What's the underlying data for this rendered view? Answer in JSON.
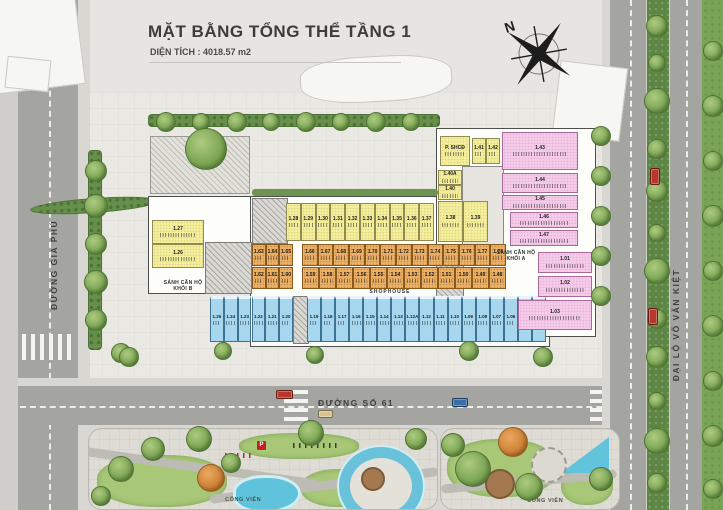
{
  "header": {
    "title": "MẶT BẰNG TỔNG THỂ TẦNG 1",
    "subtitle": "DIỆN TÍCH : 4018.57 m2"
  },
  "compass": {
    "label": "N"
  },
  "streets": {
    "left": "ĐƯỜNG GIA PHÚ",
    "bottom": "ĐƯỜNG SỐ 61",
    "right": "ĐẠI LỘ VÕ VĂN KIỆT"
  },
  "building": {
    "labels": {
      "lobby_a": "SẢNH CĂN HỘ\nKHỐI A",
      "lobby_b": "SẢNH CĂN HỘ\nKHỐI B",
      "shophouse": "SHOPHOUSE"
    },
    "blocks": [
      {
        "name": "yellow-top-row",
        "color": "yellow",
        "x": 286,
        "y": 203,
        "w": 148,
        "h": 38,
        "labels": [
          "1.28",
          "1.29",
          "1.30",
          "1.31",
          "1.32",
          "1.33",
          "1.34",
          "1.35",
          "1.36",
          "1.37"
        ]
      },
      {
        "name": "yellow-pair",
        "color": "yellow",
        "x": 438,
        "y": 201,
        "w": 50,
        "h": 41,
        "labels": [
          "1.38",
          "1.39"
        ]
      },
      {
        "name": "orange-top-left",
        "color": "orange",
        "x": 252,
        "y": 244,
        "w": 41,
        "h": 22,
        "labels": [
          "1.63",
          "1.64",
          "1.65"
        ]
      },
      {
        "name": "orange-top-right",
        "color": "orange",
        "x": 302,
        "y": 244,
        "w": 204,
        "h": 22,
        "labels": [
          "1.66",
          "1.67",
          "1.68",
          "1.69",
          "1.70",
          "1.71",
          "1.72",
          "1.73",
          "1.74",
          "1.75",
          "1.76",
          "1.77",
          "1.78"
        ]
      },
      {
        "name": "orange-bottom-left",
        "color": "orange",
        "x": 252,
        "y": 267,
        "w": 41,
        "h": 22,
        "labels": [
          "1.62",
          "1.61",
          "1.60"
        ]
      },
      {
        "name": "orange-bottom-right",
        "color": "orange",
        "x": 302,
        "y": 267,
        "w": 204,
        "h": 22,
        "labels": [
          "1.59",
          "1.58",
          "1.57",
          "1.56",
          "1.55",
          "1.54",
          "1.53",
          "1.52",
          "1.51",
          "1.50",
          "1.49",
          "1.48"
        ]
      },
      {
        "name": "blue-row-left",
        "color": "blue",
        "x": 210,
        "y": 296,
        "w": 83,
        "h": 46,
        "labels": [
          "1.25",
          "1.24",
          "1.23",
          "1.22",
          "1.21",
          "1.20"
        ]
      },
      {
        "name": "blue-row-right",
        "color": "blue",
        "x": 307,
        "y": 296,
        "w": 239,
        "h": 46,
        "labels": [
          "1.19",
          "1.18",
          "1.17",
          "1.16",
          "1.15",
          "1.14",
          "1.13",
          "1.12A",
          "1.12",
          "1.11",
          "1.10",
          "1.09",
          "1.08",
          "1.07",
          "1.06",
          "1.05",
          "1.05A"
        ]
      },
      {
        "name": "yellow-left-stack",
        "color": "yellow",
        "x": 152,
        "y": 220,
        "w": 52,
        "h": 48,
        "vertical": true,
        "labels": [
          "1.27",
          "1.26"
        ]
      },
      {
        "name": "community-room",
        "color": "yellow",
        "cells": [
          {
            "label": "P. SHCĐ",
            "x": 440,
            "y": 136,
            "w": 30,
            "h": 30
          }
        ]
      },
      {
        "name": "wing-yellow-pair",
        "color": "yellow",
        "x": 472,
        "y": 138,
        "w": 28,
        "h": 26,
        "labels": [
          "1.41",
          "1.42"
        ]
      },
      {
        "name": "wing-yellow-stack",
        "color": "yellow",
        "x": 438,
        "y": 170,
        "w": 24,
        "h": 30,
        "vertical": true,
        "labels": [
          "1.40A",
          "1.40"
        ]
      },
      {
        "name": "pink-units",
        "color": "pink",
        "cells": [
          {
            "label": "1.43",
            "x": 502,
            "y": 132,
            "w": 76,
            "h": 38
          },
          {
            "label": "1.44",
            "x": 502,
            "y": 173,
            "w": 76,
            "h": 20
          },
          {
            "label": "1.45",
            "x": 502,
            "y": 195,
            "w": 76,
            "h": 15
          },
          {
            "label": "1.46",
            "x": 510,
            "y": 212,
            "w": 68,
            "h": 16
          },
          {
            "label": "1.47",
            "x": 510,
            "y": 230,
            "w": 68,
            "h": 16
          },
          {
            "label": "1.01",
            "x": 538,
            "y": 252,
            "w": 54,
            "h": 21
          },
          {
            "label": "1.02",
            "x": 538,
            "y": 276,
            "w": 54,
            "h": 21
          },
          {
            "label": "1.03",
            "x": 518,
            "y": 300,
            "w": 74,
            "h": 30
          }
        ]
      }
    ]
  },
  "parks": {
    "left_label": "CÔNG VIÊN",
    "right_label": "CÔNG VIÊN",
    "parking_sign": "P"
  },
  "site": {
    "cars": [
      {
        "color": "#b5382a",
        "x": 276,
        "y": 390,
        "w": 15,
        "h": 7
      },
      {
        "color": "#d9c290",
        "x": 318,
        "y": 410,
        "w": 13,
        "h": 6
      },
      {
        "color": "#3a6ea8",
        "x": 452,
        "y": 398,
        "w": 14,
        "h": 7
      },
      {
        "color": "#b5382a",
        "x": 650,
        "y": 168,
        "w": 8,
        "h": 15
      },
      {
        "color": "#b5382a",
        "x": 648,
        "y": 308,
        "w": 8,
        "h": 15
      }
    ]
  }
}
